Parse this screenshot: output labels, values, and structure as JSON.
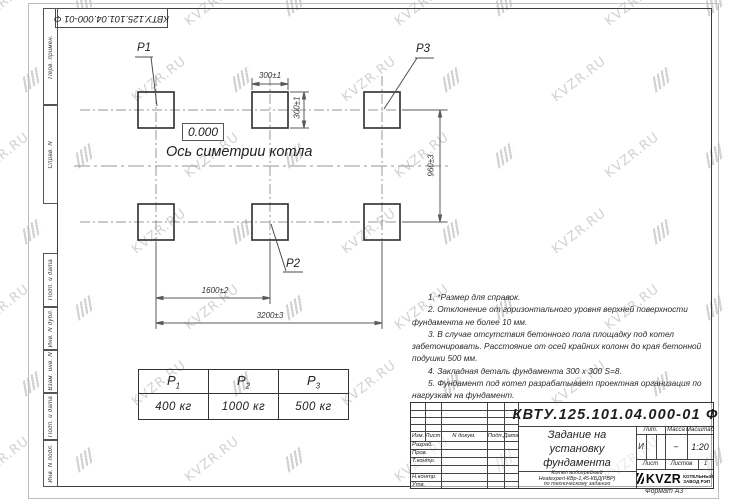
{
  "watermark": {
    "text": "KVZR.RU"
  },
  "frame": {
    "doc_number_top": "КВТУ.125.101.04.000-01 Ф",
    "format_label": "Формат А3",
    "strip_labels": [
      "Перв. примен.",
      "Справ. N",
      "Подп. и дата",
      "Инв. N дубл.",
      "Взам. инв. N",
      "Подп. и дата",
      "Инв. N подл."
    ]
  },
  "drawing": {
    "elevation": "0.000",
    "axis_label": "Ось симетрии котла",
    "point_labels": {
      "p1": "P1",
      "p2": "P2",
      "p3": "P3"
    },
    "dimensions": {
      "pad_width": "300±1",
      "pad_height": "300±1",
      "row_spacing": "960±3",
      "col_spacing": "1600±2",
      "total_span": "3200±3"
    }
  },
  "notes": {
    "items": [
      "1.  *Размер для справок.",
      "2.  Отклонение от горизонтального уровня верхней поверхности фундамента не более 10 мм.",
      "3.  В случае отсутствия бетонного пола площадку под котел забетонировать. Расстояние от осей крайних колонн до края бетонной подушки 500 мм.",
      "4.  Закладная деталь фундамента  300 x 300 S=8.",
      "5.  Фундамент под котел разрабатывает проектная организация по нагрузкам на фундамент."
    ]
  },
  "loads_table": {
    "headers": [
      {
        "base": "P",
        "sub": "1"
      },
      {
        "base": "P",
        "sub": "2"
      },
      {
        "base": "P",
        "sub": "3"
      }
    ],
    "values": [
      "400 кг",
      "1000 кг",
      "500 кг"
    ]
  },
  "title_block": {
    "doc_number": "КВТУ.125.101.04.000-01 Ф",
    "title_lines": [
      "Задание на",
      "установку",
      "фундамента"
    ],
    "subtitle_lines": [
      "Котел водогрейный",
      "Heatexpert-КВр-1,45-КБД(РВР)",
      "по техническому заданию"
    ],
    "change_header": {
      "izm": "Изм.",
      "list": "Лист",
      "doc": "N докум.",
      "sign": "Подп.",
      "date": "Дата"
    },
    "role_rows": [
      "Разраб.",
      "Пров.",
      "Т.контр.",
      "",
      "Н.контр.",
      "Утв."
    ],
    "lit_header": "Лит.",
    "mass_header": "Масса",
    "scale_header": "Масштаб",
    "lit_value": "И",
    "mass_value": "–",
    "scale_value": "1:20",
    "sheet_label": "Лист",
    "sheets_label": "Листов",
    "sheets_value": "1",
    "company": {
      "name": "KVZR",
      "line1": "КОТЕЛЬНЫЙ",
      "line2": "ЗАВОД РЭП"
    }
  }
}
